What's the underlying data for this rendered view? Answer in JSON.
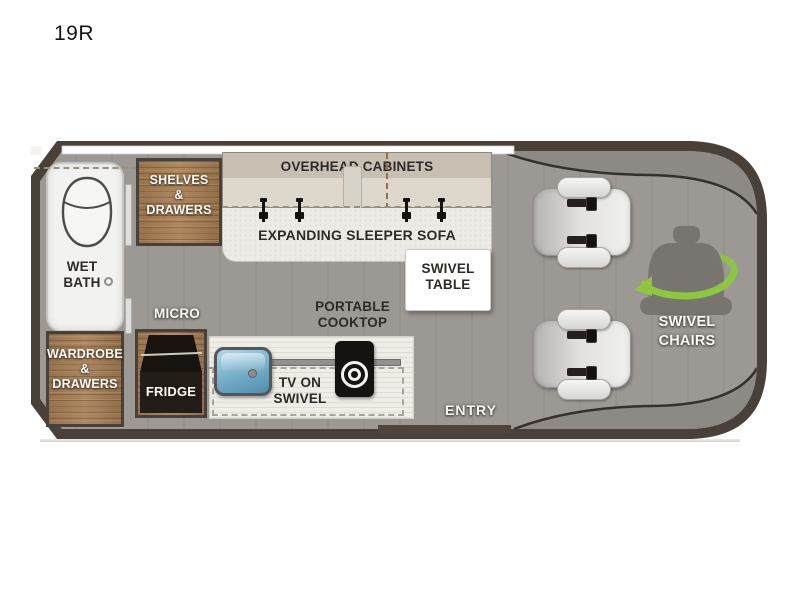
{
  "title": "19R",
  "colors": {
    "outline_dark": "#4a403a",
    "floor_gray": "#9c9894",
    "cab_shadow_gray": "#8d8a86",
    "wood_brown": "#a87f54",
    "accent_green": "#8dc63f",
    "tv_blue": "#6ea9c6",
    "sofa_cream": "#edebe6",
    "cabinet_beige": "#d2ccc0",
    "counter_cream": "#efede7",
    "bath_white": "#f2f2f0"
  },
  "floorplan": {
    "wet_bath": {
      "lines": [
        "WET",
        "BATH"
      ]
    },
    "shelves": {
      "lines": [
        "SHELVES",
        "&",
        "DRAWERS"
      ]
    },
    "wardrobe": {
      "lines": [
        "WARDROBE",
        "&",
        "DRAWERS"
      ]
    },
    "overhead_cabinets": {
      "label": "OVERHEAD CABINETS"
    },
    "sleeper_sofa": {
      "label": "EXPANDING SLEEPER SOFA"
    },
    "swivel_table": {
      "lines": [
        "SWIVEL",
        "TABLE"
      ]
    },
    "micro": {
      "label": "MICRO"
    },
    "fridge": {
      "label": "FRIDGE"
    },
    "tv": {
      "lines": [
        "TV ON",
        "SWIVEL"
      ]
    },
    "cooktop": {
      "lines": [
        "PORTABLE",
        "COOKTOP"
      ]
    },
    "entry": {
      "label": "ENTRY"
    },
    "swivel_chairs": {
      "lines": [
        "SWIVEL",
        "CHAIRS"
      ]
    }
  }
}
